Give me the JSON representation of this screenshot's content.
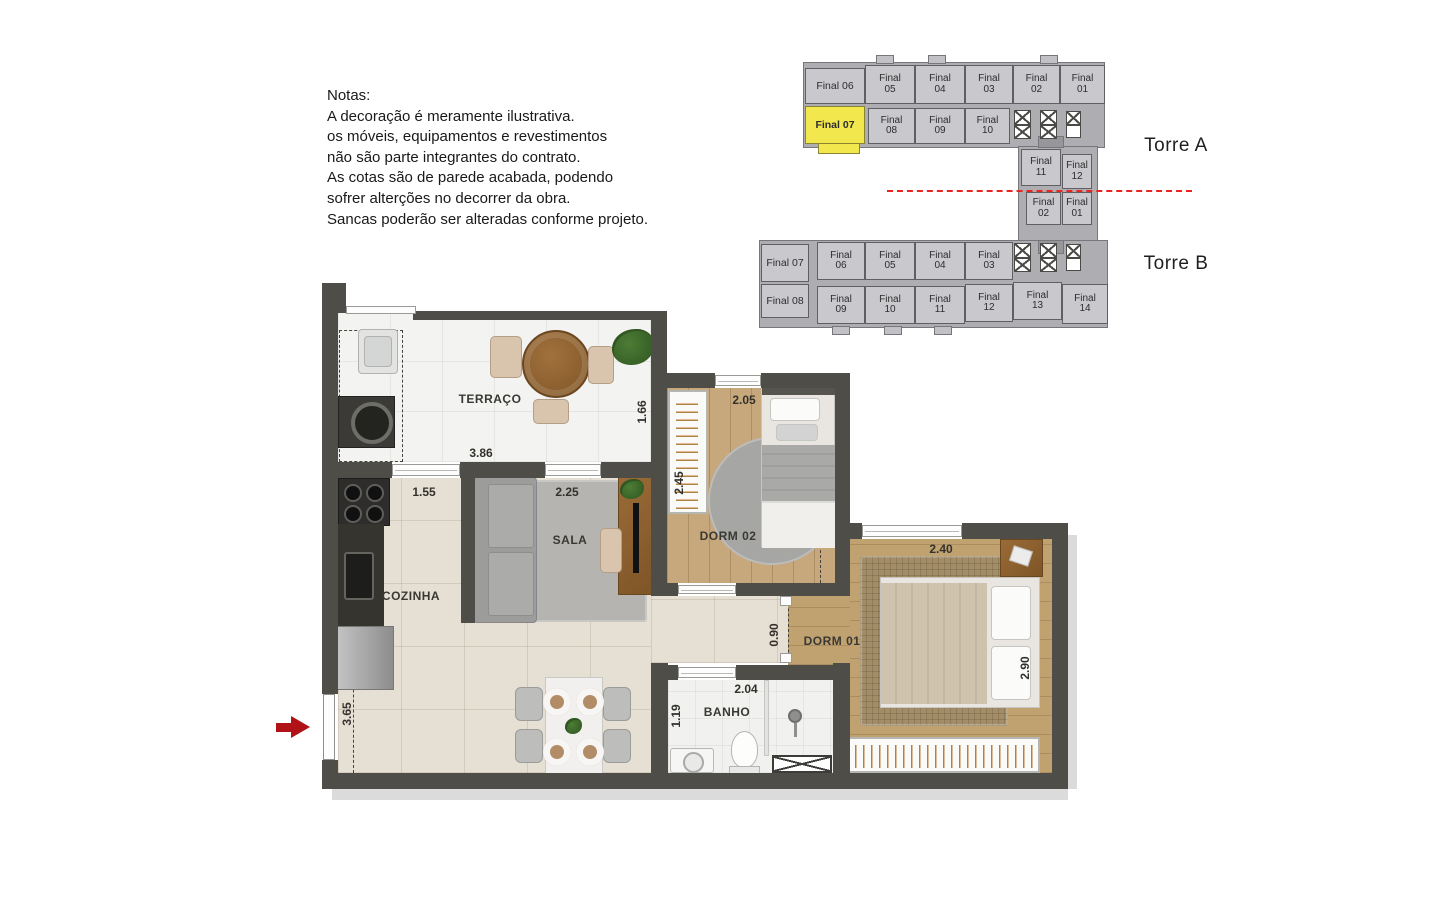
{
  "notes": {
    "lines": [
      "Notas:",
      "A decoração é meramente ilustrativa.",
      "os móveis, equipamentos e revestimentos",
      "não são parte integrantes do contrato.",
      "As cotas são de parede acabada, podendo",
      "sofrer alterções no decorrer da obra.",
      "Sancas poderão ser alteradas conforme projeto."
    ]
  },
  "keyplan": {
    "torre_a_label": "Torre A",
    "torre_b_label": "Torre B",
    "highlighted_unit": "Final 07",
    "highlight_color": "#f2e84d",
    "units": [
      {
        "label": "Final 06",
        "x": 805,
        "y": 68,
        "w": 60,
        "h": 36,
        "single": true
      },
      {
        "label": "Final\n05",
        "x": 865,
        "y": 65,
        "w": 50,
        "h": 39
      },
      {
        "label": "Final\n04",
        "x": 915,
        "y": 65,
        "w": 50,
        "h": 39
      },
      {
        "label": "Final\n03",
        "x": 965,
        "y": 65,
        "w": 48,
        "h": 39
      },
      {
        "label": "Final\n02",
        "x": 1013,
        "y": 65,
        "w": 47,
        "h": 39
      },
      {
        "label": "Final\n01",
        "x": 1060,
        "y": 65,
        "w": 45,
        "h": 39
      },
      {
        "label": "Final 07",
        "x": 805,
        "y": 106,
        "w": 60,
        "h": 38,
        "single": true,
        "highlight": true
      },
      {
        "label": "Final\n08",
        "x": 868,
        "y": 108,
        "w": 47,
        "h": 36
      },
      {
        "label": "Final\n09",
        "x": 915,
        "y": 108,
        "w": 50,
        "h": 36
      },
      {
        "label": "Final\n10",
        "x": 965,
        "y": 108,
        "w": 45,
        "h": 36
      },
      {
        "label": "Final\n11",
        "x": 1021,
        "y": 149,
        "w": 40,
        "h": 37
      },
      {
        "label": "Final\n12",
        "x": 1062,
        "y": 154,
        "w": 30,
        "h": 35
      },
      {
        "label": "Final\n02",
        "x": 1026,
        "y": 192,
        "w": 35,
        "h": 33
      },
      {
        "label": "Final\n01",
        "x": 1062,
        "y": 192,
        "w": 30,
        "h": 33
      },
      {
        "label": "Final 07",
        "x": 761,
        "y": 244,
        "w": 48,
        "h": 38,
        "single": true
      },
      {
        "label": "Final\n06",
        "x": 817,
        "y": 242,
        "w": 48,
        "h": 38
      },
      {
        "label": "Final\n05",
        "x": 865,
        "y": 242,
        "w": 50,
        "h": 38
      },
      {
        "label": "Final\n04",
        "x": 915,
        "y": 242,
        "w": 50,
        "h": 38
      },
      {
        "label": "Final\n03",
        "x": 965,
        "y": 242,
        "w": 48,
        "h": 38
      },
      {
        "label": "Final 08",
        "x": 761,
        "y": 284,
        "w": 48,
        "h": 34,
        "single": true
      },
      {
        "label": "Final\n09",
        "x": 817,
        "y": 286,
        "w": 48,
        "h": 38
      },
      {
        "label": "Final\n10",
        "x": 865,
        "y": 286,
        "w": 50,
        "h": 38
      },
      {
        "label": "Final\n11",
        "x": 915,
        "y": 286,
        "w": 50,
        "h": 38
      },
      {
        "label": "Final\n12",
        "x": 965,
        "y": 284,
        "w": 48,
        "h": 38
      },
      {
        "label": "Final\n13",
        "x": 1013,
        "y": 282,
        "w": 49,
        "h": 38
      },
      {
        "label": "Final\n14",
        "x": 1062,
        "y": 284,
        "w": 46,
        "h": 40
      }
    ],
    "elevators": [
      {
        "x": 1014,
        "y": 110,
        "w": 17,
        "h": 29,
        "cells": 2
      },
      {
        "x": 1040,
        "y": 110,
        "w": 17,
        "h": 29,
        "cells": 2
      },
      {
        "x": 1066,
        "y": 111,
        "w": 15,
        "h": 27,
        "cells": 1
      },
      {
        "x": 1014,
        "y": 243,
        "w": 17,
        "h": 29,
        "cells": 2
      },
      {
        "x": 1040,
        "y": 243,
        "w": 17,
        "h": 29,
        "cells": 2
      },
      {
        "x": 1066,
        "y": 244,
        "w": 15,
        "h": 27,
        "cells": 1
      }
    ]
  },
  "floorplan": {
    "room_labels": [
      {
        "text": "TERRAÇO",
        "x": 490,
        "y": 399
      },
      {
        "text": "COZINHA",
        "x": 411,
        "y": 596
      },
      {
        "text": "SALA",
        "x": 570,
        "y": 540
      },
      {
        "text": "DORM 02",
        "x": 728,
        "y": 536
      },
      {
        "text": "DORM 01",
        "x": 832,
        "y": 641
      },
      {
        "text": "BANHO",
        "x": 727,
        "y": 712
      }
    ],
    "dimensions": [
      {
        "text": "3.86",
        "x": 481,
        "y": 453,
        "vertical": false
      },
      {
        "text": "1.66",
        "x": 642,
        "y": 412,
        "vertical": true
      },
      {
        "text": "1.55",
        "x": 424,
        "y": 492,
        "vertical": false
      },
      {
        "text": "2.25",
        "x": 567,
        "y": 492,
        "vertical": false
      },
      {
        "text": "2.05",
        "x": 744,
        "y": 400,
        "vertical": false
      },
      {
        "text": "2.45",
        "x": 679,
        "y": 483,
        "vertical": true
      },
      {
        "text": "0.90",
        "x": 774,
        "y": 635,
        "vertical": true
      },
      {
        "text": "2.40",
        "x": 941,
        "y": 549,
        "vertical": false
      },
      {
        "text": "2.90",
        "x": 1025,
        "y": 668,
        "vertical": true
      },
      {
        "text": "2.04",
        "x": 746,
        "y": 689,
        "vertical": false
      },
      {
        "text": "1.19",
        "x": 676,
        "y": 716,
        "vertical": true
      },
      {
        "text": "3.65",
        "x": 347,
        "y": 714,
        "vertical": true
      }
    ],
    "entrance_arrow_color": "#b01217"
  }
}
